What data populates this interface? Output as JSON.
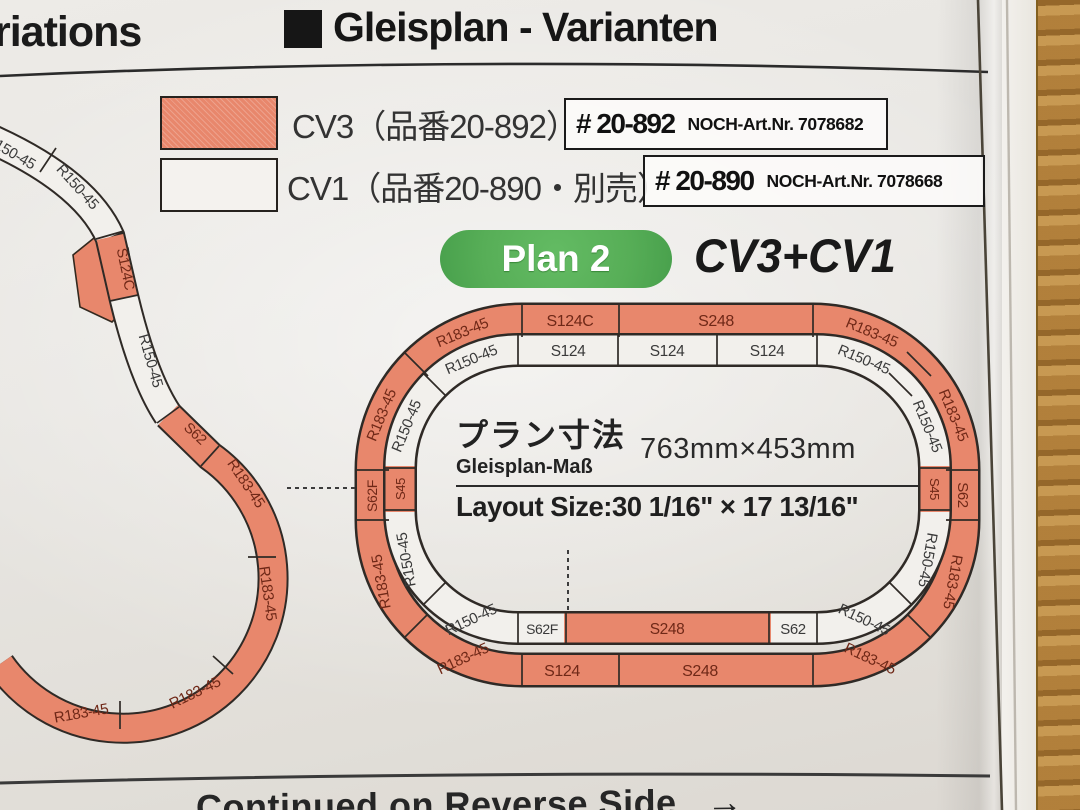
{
  "header": {
    "clipped_left_text": "riations",
    "title": "Gleisplan - Varianten"
  },
  "legend": [
    {
      "name": "CV3",
      "label": "CV3（品番20-892）",
      "part": "# 20-892",
      "noch": "NOCH-Art.Nr. 7078682"
    },
    {
      "name": "CV1",
      "label": "CV1（品番20-890・別売）",
      "part": "# 20-890",
      "noch": "NOCH-Art.Nr. 7078668"
    }
  ],
  "plan": {
    "badge": "Plan 2",
    "title": "CV3+CV1"
  },
  "dimensions": {
    "title_jp": "プラン寸法",
    "title_de": "Gleisplan-Maß",
    "metric": "763mm×453mm",
    "imperial": "Layout Size:30 1/16\" × 17 13/16\""
  },
  "footer": {
    "text": "Continued on Reverse Side",
    "arrow": "→"
  },
  "colors": {
    "cv3_track": "#E8876C",
    "cv1_track": "#F2F0EC",
    "label_on_cv3": "#6F2817",
    "label_on_cv1": "#3A3A3A",
    "badge_green": "#57AE57",
    "paper": "#E8E6E2",
    "wood": "#BC8A42"
  },
  "track_labels": {
    "outer": [
      {
        "label": "R183-45",
        "x": 464,
        "y": 337,
        "r": -22.5
      },
      {
        "label": "S124C",
        "x": 570,
        "y": 326,
        "r": 0,
        "fs": 16
      },
      {
        "label": "S248",
        "x": 716,
        "y": 326,
        "r": 0,
        "fs": 16
      },
      {
        "label": "R183-45",
        "x": 870,
        "y": 337,
        "r": 22.5
      },
      {
        "label": "R183-45",
        "x": 949,
        "y": 417,
        "r": 67.5
      },
      {
        "label": "S62",
        "x": 958,
        "y": 495,
        "r": 90
      },
      {
        "label": "R183-45",
        "x": 948,
        "y": 581,
        "r": 100
      },
      {
        "label": "R183-45",
        "x": 868,
        "y": 663,
        "r": 25
      },
      {
        "label": "S248",
        "x": 700,
        "y": 676,
        "r": 0,
        "fs": 16
      },
      {
        "label": "S124",
        "x": 562,
        "y": 676,
        "r": 0,
        "fs": 16
      },
      {
        "label": "R183-45",
        "x": 465,
        "y": 663,
        "r": -25
      },
      {
        "label": "R183-45",
        "x": 386,
        "y": 581,
        "r": -100
      },
      {
        "label": "S62F",
        "x": 377,
        "y": 496,
        "r": -90,
        "fs": 14
      },
      {
        "label": "R183-45",
        "x": 386,
        "y": 417,
        "r": -67.5
      }
    ],
    "inner": [
      {
        "label": "R150-45",
        "x": 473,
        "y": 364,
        "r": -22.5
      },
      {
        "label": "S124",
        "x": 568,
        "y": 356,
        "r": 0,
        "fs": 15.5
      },
      {
        "label": "S124",
        "x": 667,
        "y": 356,
        "r": 0,
        "fs": 15.5
      },
      {
        "label": "S124",
        "x": 767,
        "y": 356,
        "r": 0,
        "fs": 15.5
      },
      {
        "label": "R150-45",
        "x": 862,
        "y": 364,
        "r": 22.5
      },
      {
        "label": "R150-45",
        "x": 923,
        "y": 428,
        "r": 67.5
      },
      {
        "label": "S45",
        "x": 930,
        "y": 489,
        "r": 90,
        "on": "cv3",
        "fs": 13
      },
      {
        "label": "R150-45",
        "x": 923,
        "y": 559,
        "r": 100
      },
      {
        "label": "R150-45",
        "x": 862,
        "y": 624,
        "r": 25
      },
      {
        "label": "S62",
        "x": 793,
        "y": 634,
        "r": 0
      },
      {
        "label": "S248",
        "x": 667,
        "y": 634,
        "r": 0,
        "on": "cv3",
        "fs": 15.5
      },
      {
        "label": "S62F",
        "x": 542,
        "y": 634,
        "r": 0,
        "fs": 14
      },
      {
        "label": "R150-45",
        "x": 473,
        "y": 624,
        "r": -25
      },
      {
        "label": "R150-45",
        "x": 411,
        "y": 559,
        "r": -100
      },
      {
        "label": "S45",
        "x": 405,
        "y": 489,
        "r": -90,
        "on": "cv3",
        "fs": 13
      },
      {
        "label": "R150-45",
        "x": 411,
        "y": 428,
        "r": -67.5
      }
    ],
    "left": [
      {
        "label": "R150-45",
        "x": 8,
        "y": 156,
        "r": 30
      },
      {
        "label": "R150-45",
        "x": 74,
        "y": 190,
        "r": 48
      },
      {
        "label": "S124C",
        "x": 121,
        "y": 270,
        "r": 78,
        "on": "cv3",
        "fs": 14.5
      },
      {
        "label": "R150-45",
        "x": 146,
        "y": 362,
        "r": 74
      },
      {
        "label": "S62",
        "x": 192,
        "y": 437,
        "r": 43,
        "on": "cv3",
        "fs": 14.5
      },
      {
        "label": "R183-45",
        "x": 242,
        "y": 486,
        "r": 56,
        "on": "cv3"
      },
      {
        "label": "R183-45",
        "x": 263,
        "y": 594,
        "r": 82,
        "on": "cv3"
      },
      {
        "label": "R183-45",
        "x": 197,
        "y": 697,
        "r": -26,
        "on": "cv3"
      },
      {
        "label": "R183-45",
        "x": 82,
        "y": 718,
        "r": -10,
        "on": "cv3"
      }
    ]
  }
}
